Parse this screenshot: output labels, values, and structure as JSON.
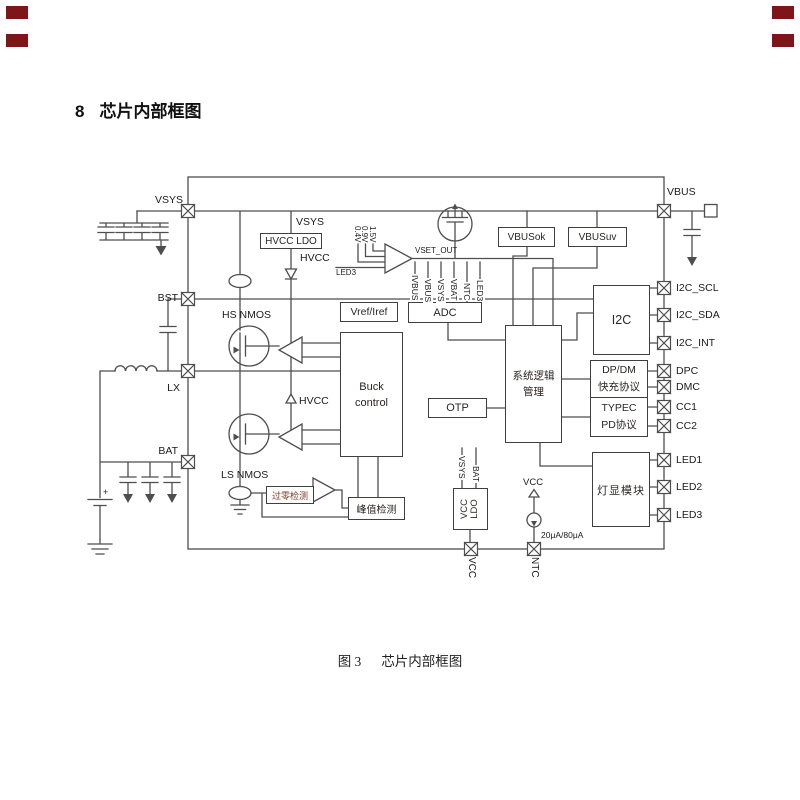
{
  "title": {
    "number": "8",
    "text": "芯片内部框图"
  },
  "caption": {
    "prefix": "图 3",
    "text": "芯片内部框图"
  },
  "colors": {
    "line": "#4e4e4e",
    "corner_mark": "#7e1518",
    "zero_cross_text": "#7c3a2a"
  },
  "pins": {
    "left": {
      "vsys": "VSYS",
      "bst": "BST",
      "lx": "LX",
      "bat": "BAT"
    },
    "right_top": "VBUS",
    "right": [
      "I2C_SCL",
      "I2C_SDA",
      "I2C_INT",
      "DPC",
      "DMC",
      "CC1",
      "CC2",
      "LED1",
      "LED2",
      "LED3"
    ],
    "bottom": [
      "VCC",
      "NTC"
    ]
  },
  "blocks": {
    "hvcc_ldo": "HVCC LDO",
    "vref_iref": "Vref/Iref",
    "adc": "ADC",
    "buck_line1": "Buck",
    "buck_line2": "control",
    "otp": "OTP",
    "vbusok": "VBUSok",
    "vbusuv": "VBUSuv",
    "sys_line1": "系统逻辑",
    "sys_line2": "管理",
    "i2c": "I2C",
    "dpdm_line1": "DP/DM",
    "dpdm_line2": "快充协议",
    "typec_line1": "TYPEC",
    "typec_line2": "PD协议",
    "led_module": "灯显模块",
    "peak_detect": "峰值检测",
    "zero_cross": "过零检测",
    "vcc_ldo_line1": "VCC",
    "vcc_ldo_line2": "LDO"
  },
  "signals": {
    "hs_nmos": "HS NMOS",
    "ls_nmos": "LS NMOS",
    "hvcc_ldo_in": "VSYS",
    "hvcc_ldo_out": "HVCC",
    "hvcc_rail": "HVCC",
    "vset_out": "VSET_OUT",
    "vref_04": "0.4V",
    "vref_09": "0.9V",
    "vref_15": "1.5V",
    "led3_sel": "LED3",
    "adc_inputs": [
      "IVBUS",
      "VBUS",
      "VSYS",
      "VBAT",
      "NTC",
      "LED3"
    ],
    "vcc_ldo_in1": "VSYS",
    "vcc_ldo_in2": "BAT",
    "ntc_current": "20μA/80μA",
    "ntc_pullup": "VCC",
    "battery_plus": "+"
  }
}
